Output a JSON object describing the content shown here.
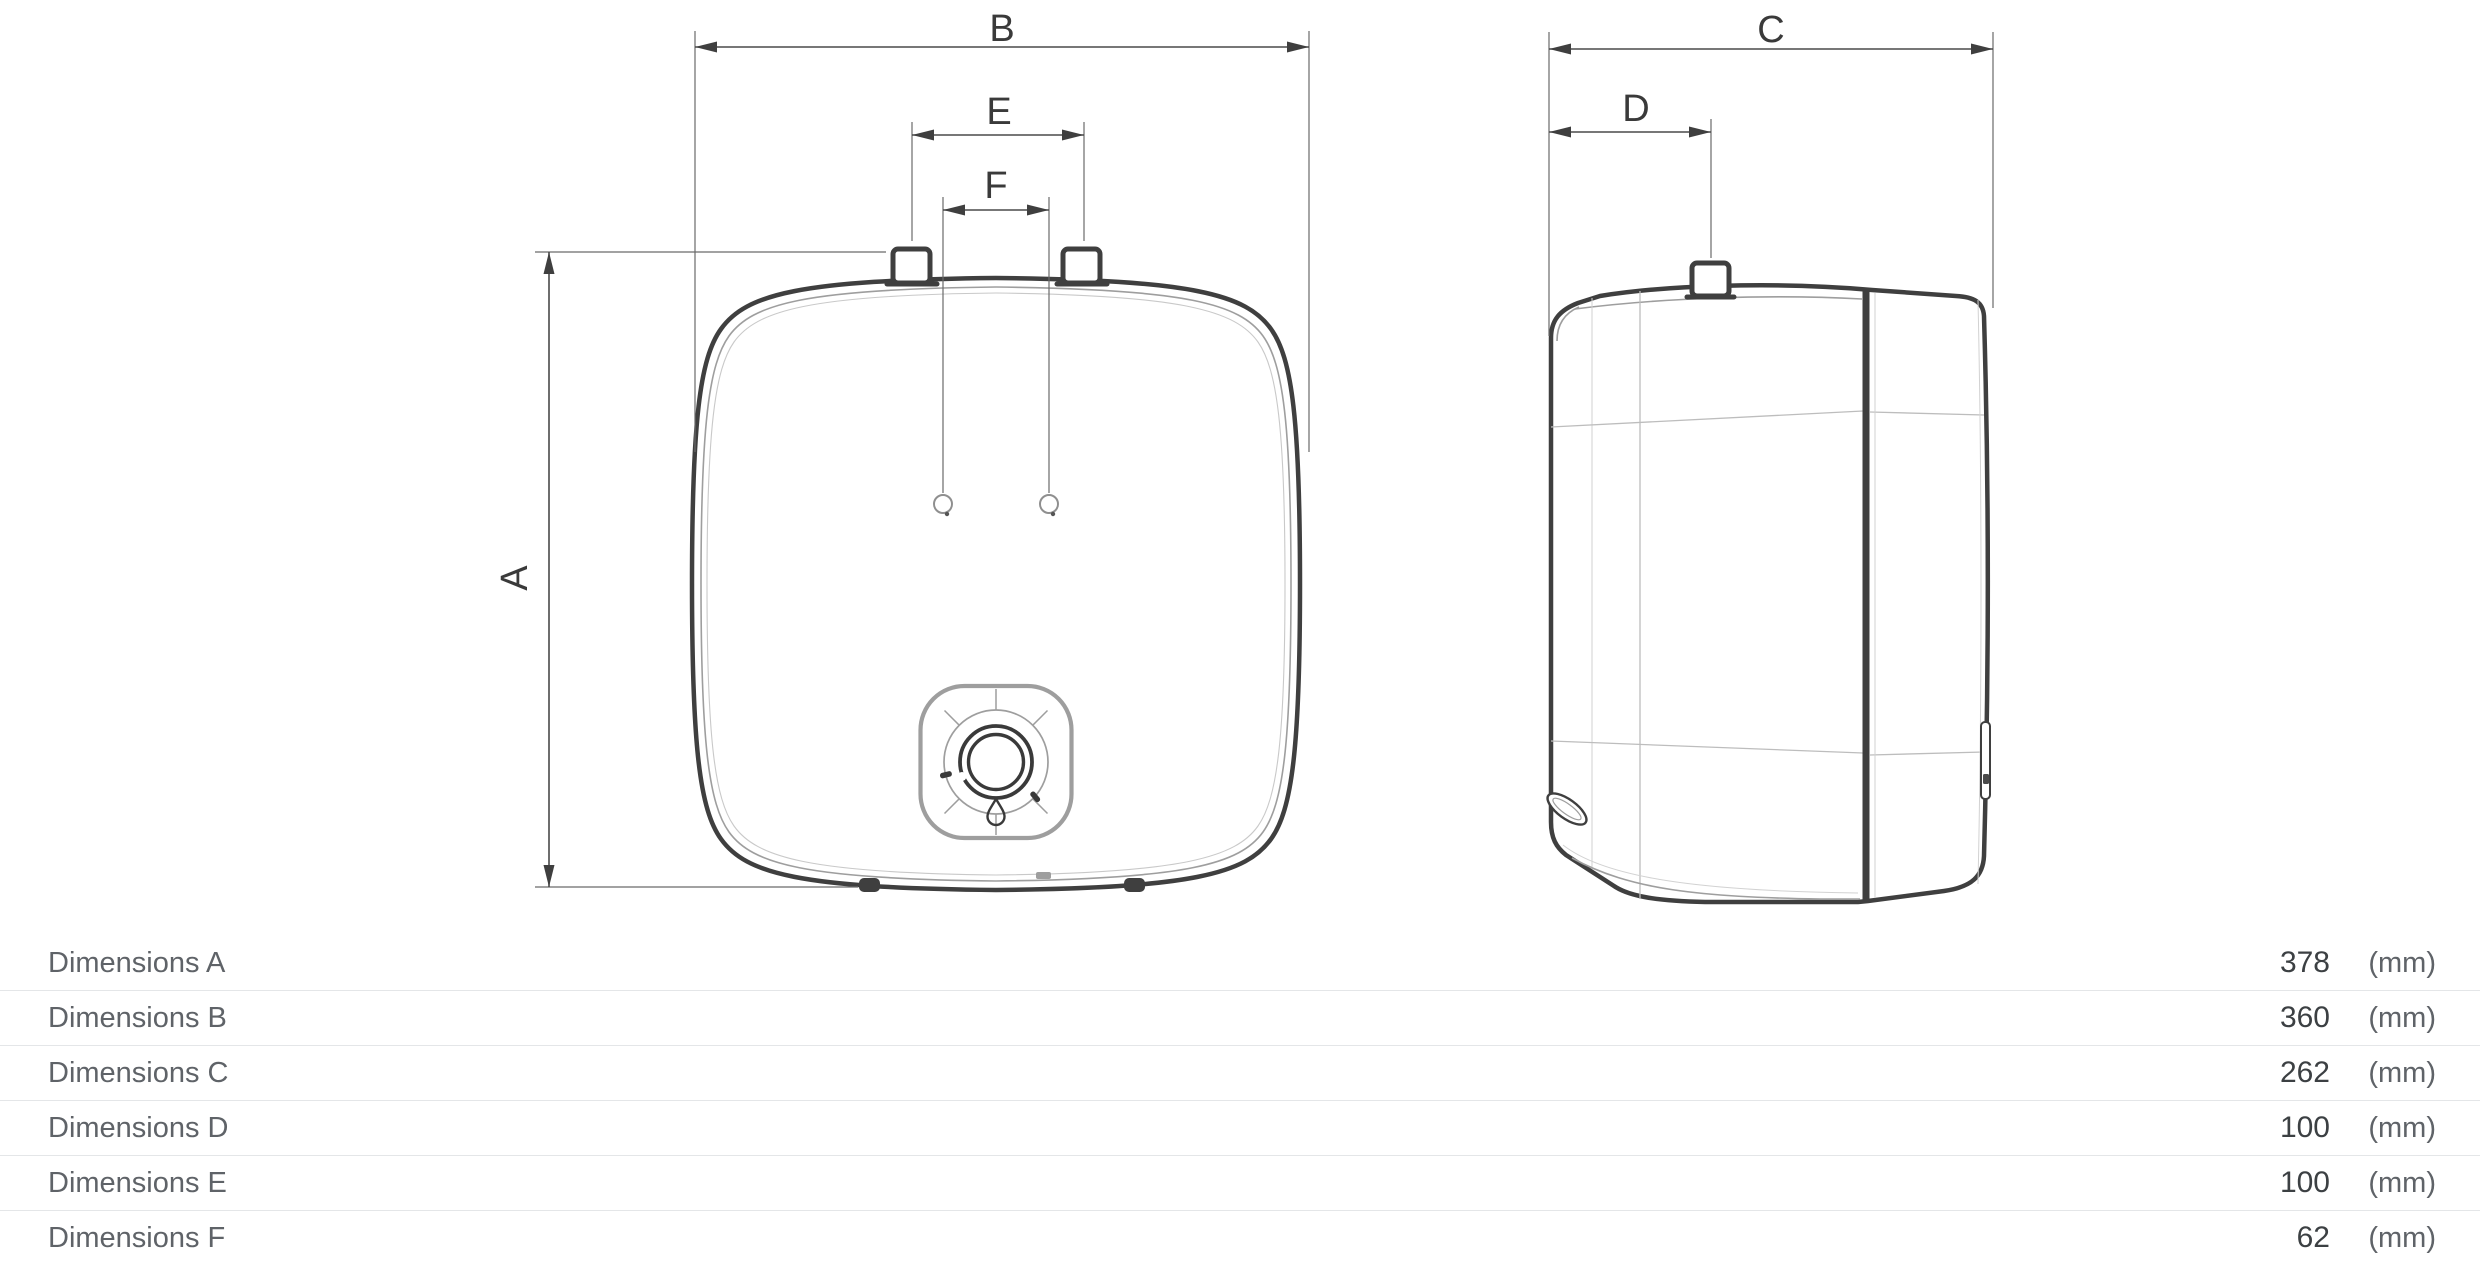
{
  "diagram": {
    "front_view": {
      "dim_labels": {
        "A": "A",
        "B": "B",
        "E": "E",
        "F": "F"
      }
    },
    "side_view": {
      "dim_labels": {
        "C": "C",
        "D": "D"
      }
    }
  },
  "dimensions_table": {
    "rows": [
      {
        "label": "Dimensions A",
        "value": "378",
        "unit": "(mm)"
      },
      {
        "label": "Dimensions B",
        "value": "360",
        "unit": "(mm)"
      },
      {
        "label": "Dimensions C",
        "value": "262",
        "unit": "(mm)"
      },
      {
        "label": "Dimensions D",
        "value": "100",
        "unit": "(mm)"
      },
      {
        "label": "Dimensions E",
        "value": "100",
        "unit": "(mm)"
      },
      {
        "label": "Dimensions F",
        "value": "62",
        "unit": "(mm)"
      }
    ]
  },
  "colors": {
    "line_dark": "#3f3f3f",
    "line_light": "#9e9e9e",
    "dim_letter": "#3a3a3a",
    "table_label": "#5f6368",
    "table_value": "#3c4043",
    "divider": "#e4e6e8",
    "background": "#ffffff"
  }
}
